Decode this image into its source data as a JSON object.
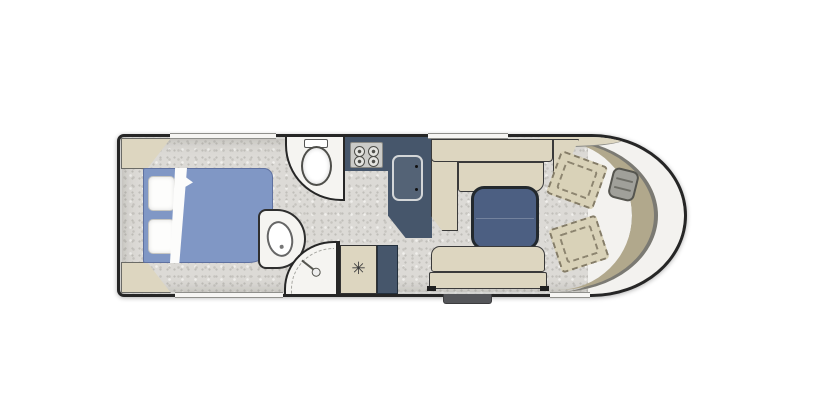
{
  "meta": {
    "title": "Motorhome floor plan"
  },
  "colors": {
    "wall": "#262626",
    "floor": "#dcdad6",
    "bed": "#8097c5",
    "upholstery": "#ddd6c0",
    "counter": "#46566b",
    "table_top": "#4c5f82",
    "dashboard": "#b1a88c",
    "cab_chair": "#d9d2b8",
    "fixture": "#f5f4f1",
    "step": "#55565a"
  },
  "icons": {
    "fan_glyph": "✳"
  },
  "fixtures": [
    "wardrobe-rear-top",
    "wardrobe-rear-bottom",
    "double-bed",
    "pillow",
    "pillow",
    "bed-sheet",
    "toilet",
    "washbasin",
    "shower",
    "roof-fan-cabinet",
    "hob-4-burner",
    "kitchen-sink",
    "kitchen-counter",
    "l-shaped-sofa",
    "pedestal-table",
    "bench-seat",
    "entry-step",
    "swivel-chair-driver",
    "swivel-chair-passenger",
    "steering-wheel",
    "dashboard",
    "windshield"
  ]
}
